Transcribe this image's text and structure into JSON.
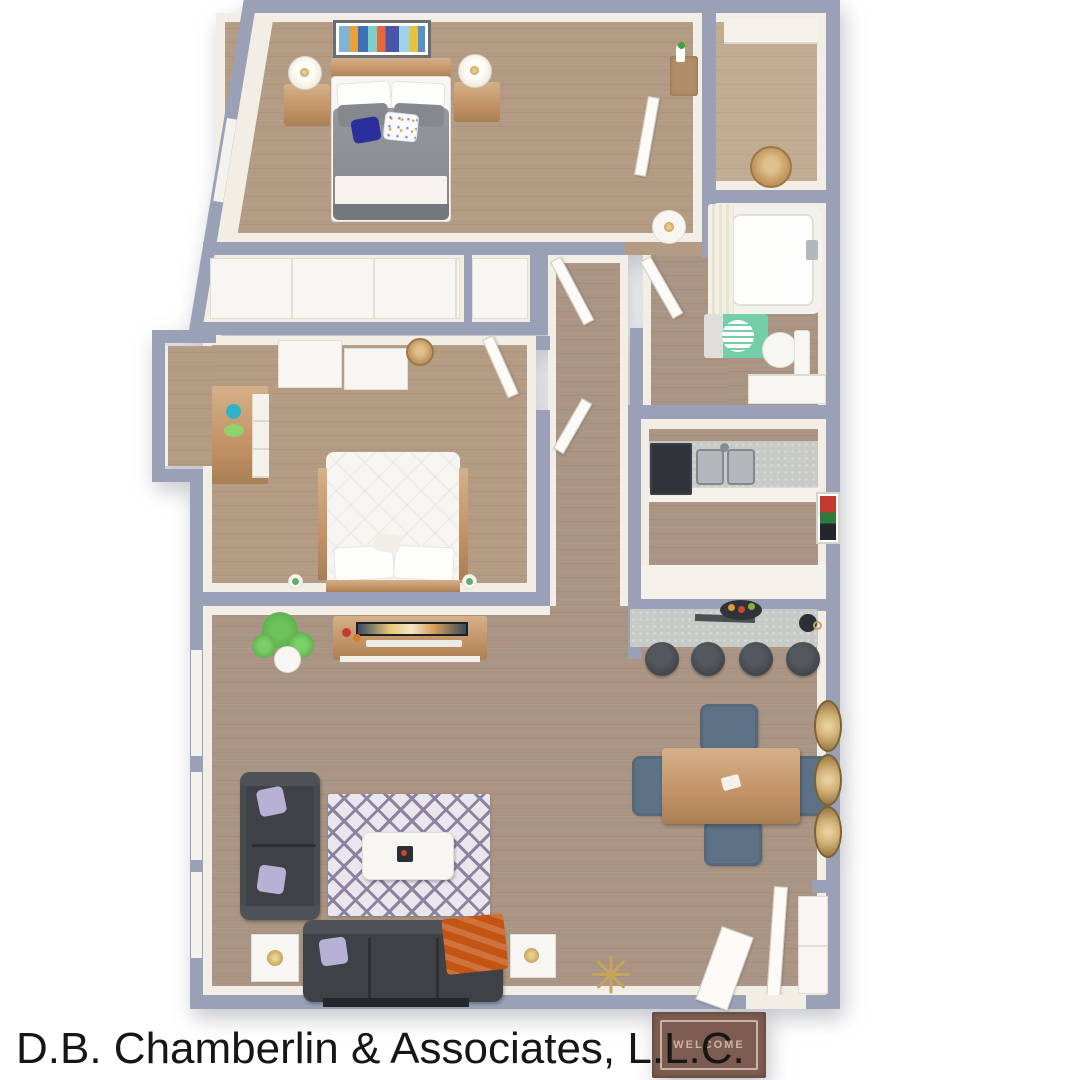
{
  "caption": {
    "text": "D.B. Chamberlin & Associates, L.L.C."
  },
  "doormat": {
    "text": "WELCOME"
  },
  "palette": {
    "wall": "#9aa0b6",
    "wallface": "#f2eee5",
    "floorwarm": "#b49b84",
    "floorcool": "#aa9584",
    "floorlight": "#c2ab93",
    "white": "#f8f6f2",
    "wood": "#c39265",
    "woodlight": "#d4b089",
    "wooddark": "#a87f54",
    "duvet": "#8b8e93",
    "duvetdark": "#74777c",
    "navy": "#2b2f9b",
    "couch": "#3e4246",
    "couchlight": "#4d5258",
    "lilac": "#b7b1d6",
    "orange": "#c35413",
    "rug": "#e9e7ed",
    "rugstripe": "#8d82a0",
    "chairblue": "#5d7286",
    "counter": "#c7cac7",
    "steel": "#b4b8bc",
    "steeldark": "#84888c",
    "dark": "#30343a",
    "greenmat": "#74cfa8",
    "teal": "#2fb3c9",
    "greenbowl": "#90d16c",
    "plant": "#5cb34e",
    "gold": "#c6a45e",
    "matbrown": "#7c5b50",
    "mattext": "#cbb3a4",
    "captioncolor": "#161616"
  }
}
